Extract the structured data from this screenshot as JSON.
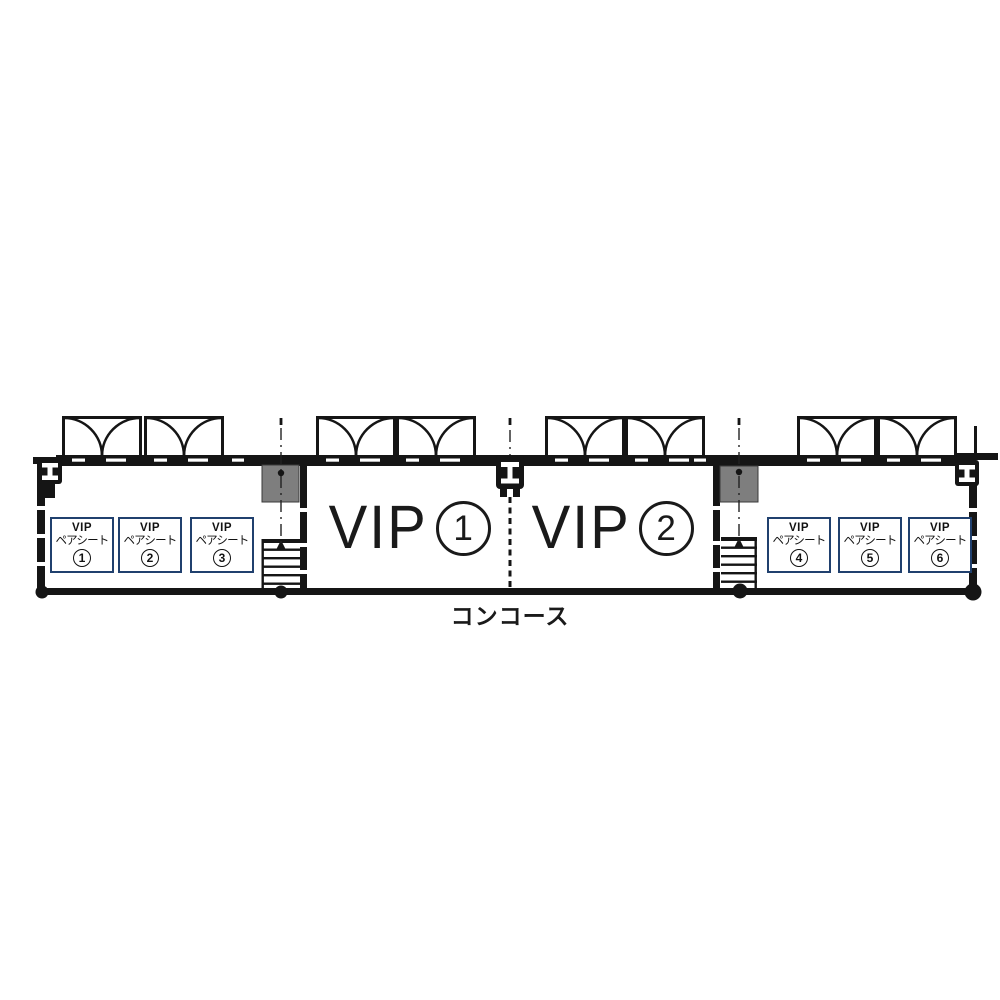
{
  "plan": {
    "concourse_label": "コンコース",
    "rooms": [
      {
        "name": "VIP",
        "number": "1"
      },
      {
        "name": "VIP",
        "number": "2"
      }
    ],
    "pair_seats": [
      {
        "title": "VIP",
        "subtitle": "ペアシート",
        "number": "1"
      },
      {
        "title": "VIP",
        "subtitle": "ペアシート",
        "number": "2"
      },
      {
        "title": "VIP",
        "subtitle": "ペアシート",
        "number": "3"
      },
      {
        "title": "VIP",
        "subtitle": "ペアシート",
        "number": "4"
      },
      {
        "title": "VIP",
        "subtitle": "ペアシート",
        "number": "5"
      },
      {
        "title": "VIP",
        "subtitle": "ペアシート",
        "number": "6"
      }
    ],
    "icons": {
      "double-door-icon": "pair of quarter-circle door swing arcs",
      "stairs-icon": "stair treads with up arrow",
      "steel-column-icon": "white I-beam glyph in black square",
      "pillar-icon": "gray filled square shaft",
      "structural-column-dot-icon": "filled black circle"
    },
    "colors": {
      "line": "#1a1a1a",
      "seat_box_border": "#20406e",
      "pillar_fill": "#7e7e7e",
      "background": "#ffffff"
    }
  }
}
